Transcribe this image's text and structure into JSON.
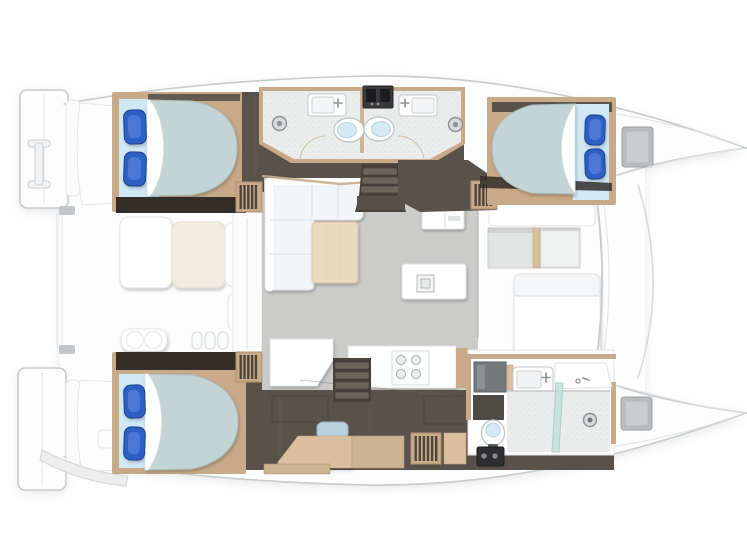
{
  "meta": {
    "width": 747,
    "height": 560,
    "kind": "catamaran-interior-floor-plan",
    "visible_text": ""
  },
  "colors": {
    "hullStroke": "#c6cbce",
    "furnitureStroke": "#e1e4e6",
    "floorDark": "#59524a",
    "floorDarker": "#332e29",
    "wood": "#c9aa88",
    "woodLight": "#d9bf9f",
    "woodPale": "#ead9bf",
    "mattress": "#c3d4d5",
    "sheet": "#cfe9f7",
    "pillow": "#2f5fc4",
    "pillowDark": "#1d3f8f",
    "bathFloor": "#ebecec",
    "salonFloor": "#cbcbc9",
    "cream": "#f1ece0",
    "hatchGray": "#b9bdbf",
    "applianceDark": "#3a3a3c",
    "mirrorGray": "#75797c",
    "glassTeal": "#bfe0db",
    "benchBlue": "#b9d0dd",
    "toiletBlue": "#d4e9f4"
  },
  "inventory": {
    "double_beds": 3,
    "toilets": 3,
    "sinks": 4,
    "shower_heads": 2,
    "shower_stall": 1,
    "cooktop_burners": 4,
    "stair_flights": 4,
    "cockpit_items": [
      "bench",
      "table",
      "bench",
      "seat-with-two-cushions",
      "winch-handles"
    ],
    "salon_items": [
      "l-sofa",
      "coffee-table",
      "galley-island-sink",
      "cooktop-counter",
      "fridge-cabinet",
      "forward-lounge",
      "footwell"
    ]
  }
}
